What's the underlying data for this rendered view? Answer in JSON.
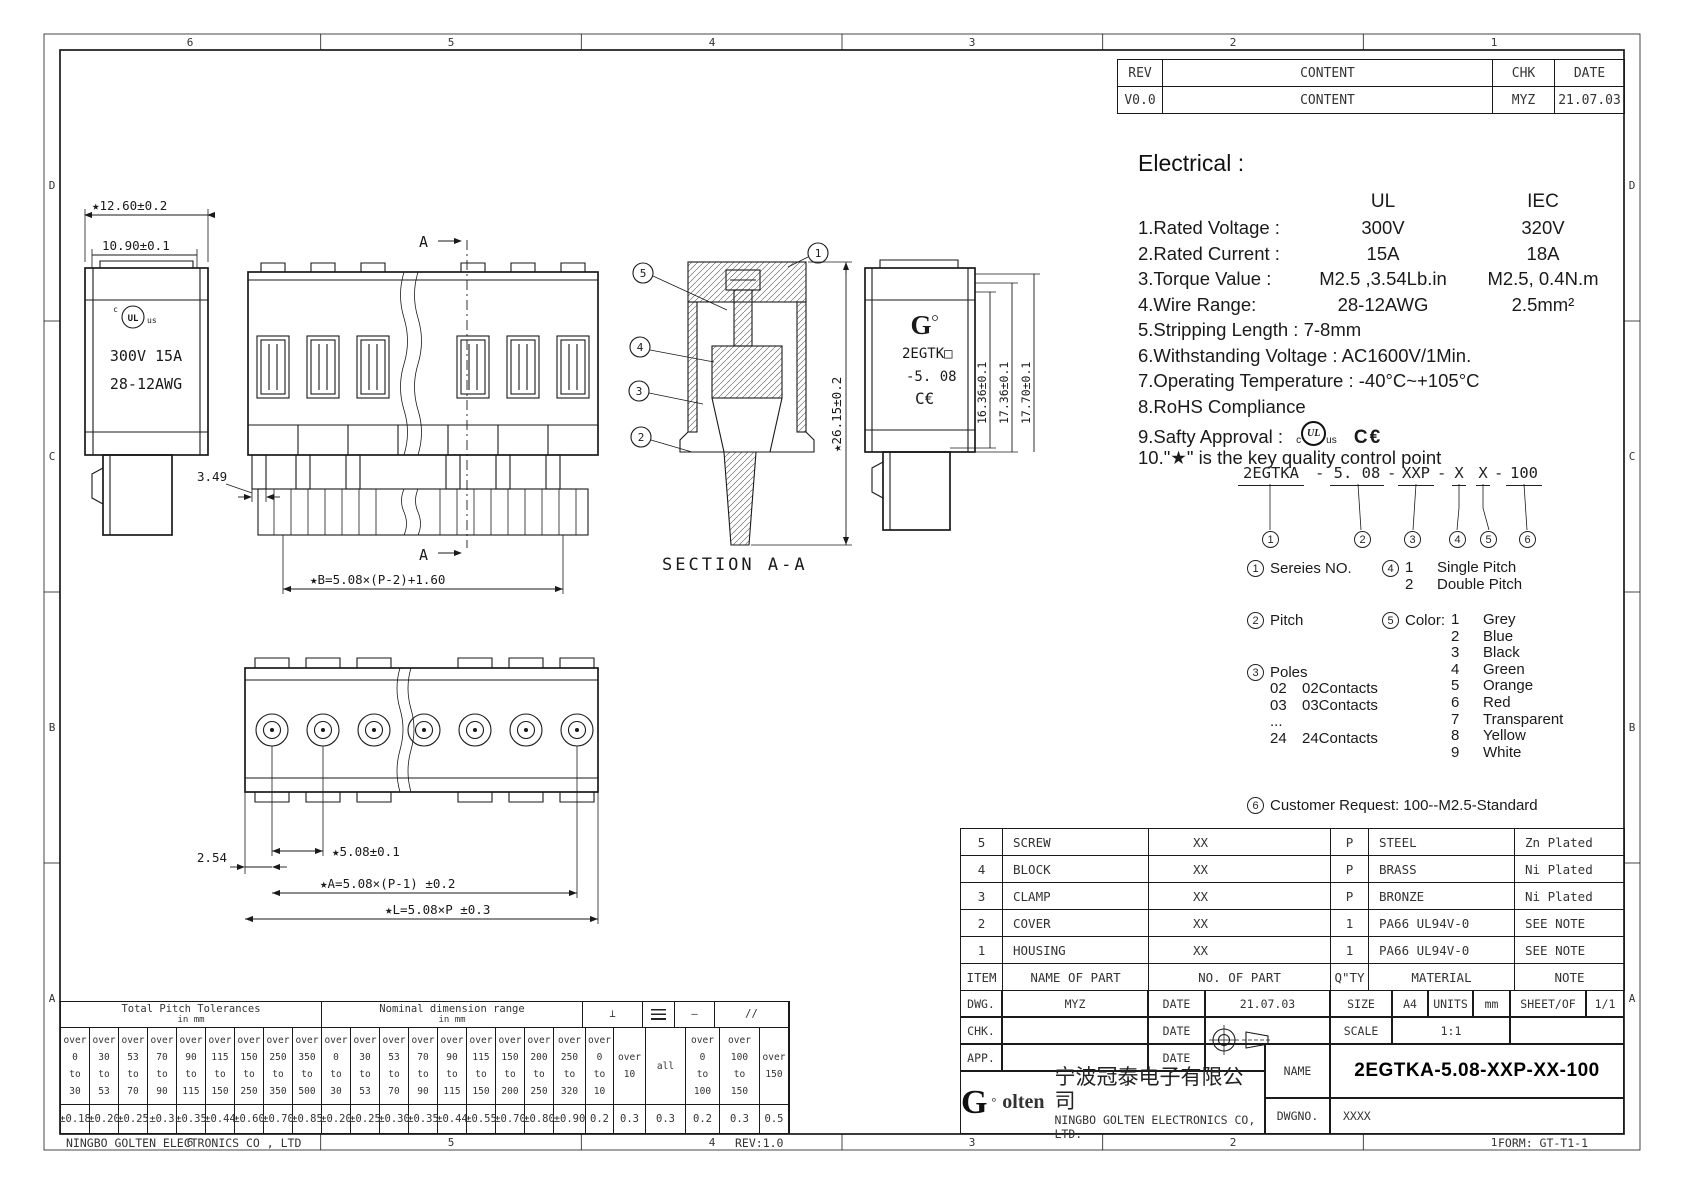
{
  "page": {
    "footer_company": "NINGBO GOLTEN ELECTRONICS CO , LTD",
    "footer_rev": "REV:1.0",
    "footer_form": "FORM: GT-T1-1"
  },
  "zones": {
    "top": [
      "6",
      "5",
      "4",
      "3",
      "2",
      "1"
    ],
    "bottom": [
      "6",
      "5",
      "4",
      "3",
      "2",
      "1"
    ],
    "left": [
      "D",
      "C",
      "B",
      "A"
    ],
    "right": [
      "D",
      "C",
      "B",
      "A"
    ]
  },
  "revision_table": {
    "col_rev": "REV",
    "col_content": "CONTENT",
    "col_chk": "CHK",
    "col_date": "DATE",
    "row": {
      "rev": "V0.0",
      "content": "CONTENT",
      "chk": "MYZ",
      "date": "21.07.03"
    }
  },
  "electrical": {
    "title": "Electrical :",
    "col_ul": "UL",
    "col_iec": "IEC",
    "rows": [
      {
        "label": "1.Rated Voltage :",
        "ul": "300V",
        "iec": "320V"
      },
      {
        "label": "2.Rated Current :",
        "ul": "15A",
        "iec": "18A"
      },
      {
        "label": "3.Torque Value :",
        "ul": "M2.5 ,3.54Lb.in",
        "iec": "M2.5, 0.4N.m"
      },
      {
        "label": "4.Wire Range:",
        "ul": "28-12AWG",
        "iec": "2.5mm²"
      }
    ],
    "lines": [
      "5.Stripping Length : 7-8mm",
      "6.Withstanding Voltage : AC1600V/1Min.",
      "7.Operating Temperature : -40°C~+105°C",
      "8.RoHS Compliance"
    ],
    "safety_label": "9.Safty Approval :",
    "safety_ul_c": "c",
    "safety_ul": "UL",
    "safety_ul_us": "us",
    "safety_ce": "C€",
    "star_note": "10.\"★\" is the key quality control point"
  },
  "ordering": {
    "segments": [
      "2EGTKA",
      "5. 08",
      "XXP",
      "X",
      "X",
      "100"
    ],
    "separator": "-",
    "markers": [
      "1",
      "2",
      "3",
      "4",
      "5",
      "6"
    ],
    "series_label": "Sereies NO.",
    "pitch_label": "Pitch",
    "poles_label": "Poles",
    "poles_options": [
      {
        "code": "02",
        "label": "02Contacts"
      },
      {
        "code": "03",
        "label": "03Contacts"
      },
      {
        "code": "...",
        "label": ""
      },
      {
        "code": "24",
        "label": "24Contacts"
      }
    ],
    "pitch_type_options": [
      {
        "code": "1",
        "label": "Single Pitch"
      },
      {
        "code": "2",
        "label": "Double Pitch"
      }
    ],
    "color_label": "Color:",
    "color_options": [
      {
        "code": "1",
        "label": "Grey"
      },
      {
        "code": "2",
        "label": "Blue"
      },
      {
        "code": "3",
        "label": "Black"
      },
      {
        "code": "4",
        "label": "Green"
      },
      {
        "code": "5",
        "label": "Orange"
      },
      {
        "code": "6",
        "label": "Red"
      },
      {
        "code": "7",
        "label": "Transparent"
      },
      {
        "code": "8",
        "label": "Yellow"
      },
      {
        "code": "9",
        "label": "White"
      }
    ],
    "customer_label": "Customer Request: 100--M2.5-Standard"
  },
  "parts_table": {
    "rows": [
      {
        "item": "5",
        "name": "SCREW",
        "no": "XX",
        "qty": "P",
        "material": "STEEL",
        "note": "Zn Plated"
      },
      {
        "item": "4",
        "name": "BLOCK",
        "no": "XX",
        "qty": "P",
        "material": "BRASS",
        "note": "Ni Plated"
      },
      {
        "item": "3",
        "name": "CLAMP",
        "no": "XX",
        "qty": "P",
        "material": "BRONZE",
        "note": "Ni Plated"
      },
      {
        "item": "2",
        "name": "COVER",
        "no": "XX",
        "qty": "1",
        "material": "PA66 UL94V-0",
        "note": "SEE NOTE"
      },
      {
        "item": "1",
        "name": "HOUSING",
        "no": "XX",
        "qty": "1",
        "material": "PA66 UL94V-0",
        "note": "SEE NOTE"
      }
    ],
    "headers": {
      "item": "ITEM",
      "name": "NAME OF PART",
      "no": "NO. OF PART",
      "qty": "Q\"TY",
      "material": "MATERIAL",
      "note": "NOTE"
    }
  },
  "title_block": {
    "dwg_label": "DWG.",
    "dwg_value": "MYZ",
    "date_label": "DATE",
    "dwg_date": "21.07.03",
    "size_label": "SIZE",
    "size_value": "A4",
    "units_label": "UNITS",
    "units_value": "mm",
    "sheet_label": "SHEET/OF",
    "sheet_value": "1/1",
    "chk_label": "CHK.",
    "scale_label": "SCALE",
    "scale_value": "1:1",
    "app_label": "APP.",
    "name_label": "NAME",
    "name_value": "2EGTKA-5.08-XXP-XX-100",
    "dwgno_label": "DWGNO.",
    "dwgno_value": "XXXX",
    "logo_g": "G",
    "logo_deg": "°",
    "logo_rest": "olten",
    "company_cn": "宁波冠泰电子有限公司",
    "company_en": "NINGBO GOLTEN ELECTRONICS CO, LTD."
  },
  "tolerance_table": {
    "pitch_title": "Total Pitch Tolerances",
    "pitch_sub": "in mm",
    "nominal_title": "Nominal dimension range",
    "nominal_sub": "in mm",
    "sym_perp": "⊥",
    "sym_straight": "—",
    "sym_parallel": "//",
    "columns": [
      {
        "h": "over\n0\nto\n30",
        "v": "±0.18"
      },
      {
        "h": "over\n30\nto\n53",
        "v": "±0.20"
      },
      {
        "h": "over\n53\nto\n70",
        "v": "±0.25"
      },
      {
        "h": "over\n70\nto\n90",
        "v": "±0.3"
      },
      {
        "h": "over\n90\nto\n115",
        "v": "±0.35"
      },
      {
        "h": "over\n115\nto\n150",
        "v": "±0.44"
      },
      {
        "h": "over\n150\nto\n250",
        "v": "±0.60"
      },
      {
        "h": "over\n250\nto\n350",
        "v": "±0.70"
      },
      {
        "h": "over\n350\nto\n500",
        "v": "±0.85"
      },
      {
        "h": "over\n0\nto\n30",
        "v": "±0.20"
      },
      {
        "h": "over\n30\nto\n53",
        "v": "±0.25"
      },
      {
        "h": "over\n53\nto\n70",
        "v": "±0.30"
      },
      {
        "h": "over\n70\nto\n90",
        "v": "±0.35"
      },
      {
        "h": "over\n90\nto\n115",
        "v": "±0.44"
      },
      {
        "h": "over\n115\nto\n150",
        "v": "±0.55"
      },
      {
        "h": "over\n150\nto\n200",
        "v": "±0.70"
      },
      {
        "h": "over\n200\nto\n250",
        "v": "±0.80"
      },
      {
        "h": "over\n250\nto\n320",
        "v": "±0.90"
      },
      {
        "h": "over\n0\nto\n10",
        "v": "0.2"
      },
      {
        "h": "over\n10",
        "v": "0.3"
      },
      {
        "h": "all",
        "v": "0.3"
      },
      {
        "h": "over\n0\nto\n100",
        "v": "0.2"
      },
      {
        "h": "over\n100\nto\n150",
        "v": "0.3"
      },
      {
        "h": "over\n150",
        "v": "0.5"
      }
    ]
  },
  "drawings": {
    "left_view": {
      "dim_width_outer": "★12.60±0.2",
      "dim_width_inner": "10.90±0.1",
      "dim_step": "3.49",
      "rating_line1": "300V 15A",
      "rating_line2": "28-12AWG",
      "ul_prefix": "c",
      "ul_logo": "UL",
      "ul_suffix": "us"
    },
    "front_view": {
      "section_marker": "A",
      "dim_b": "★B=5.08×(P-2)+1.60"
    },
    "section_view": {
      "title": "SECTION A-A",
      "dim_height": "★26.15±0.2",
      "callouts": [
        "1",
        "2",
        "3",
        "4",
        "5"
      ]
    },
    "right_view": {
      "logo": "G",
      "model_line1": "2EGTK□",
      "model_line2": "-5. 08",
      "ce_mark": "C€",
      "dim_h1": "16.36±0.1",
      "dim_h2": "17.36±0.1",
      "dim_h3": "17.70±0.1"
    },
    "bottom_view": {
      "dim_pitch": "★5.08±0.1",
      "dim_half": "2.54",
      "dim_a": "★A=5.08×(P-1) ±0.2",
      "dim_l": "★L=5.08×P ±0.3"
    }
  }
}
